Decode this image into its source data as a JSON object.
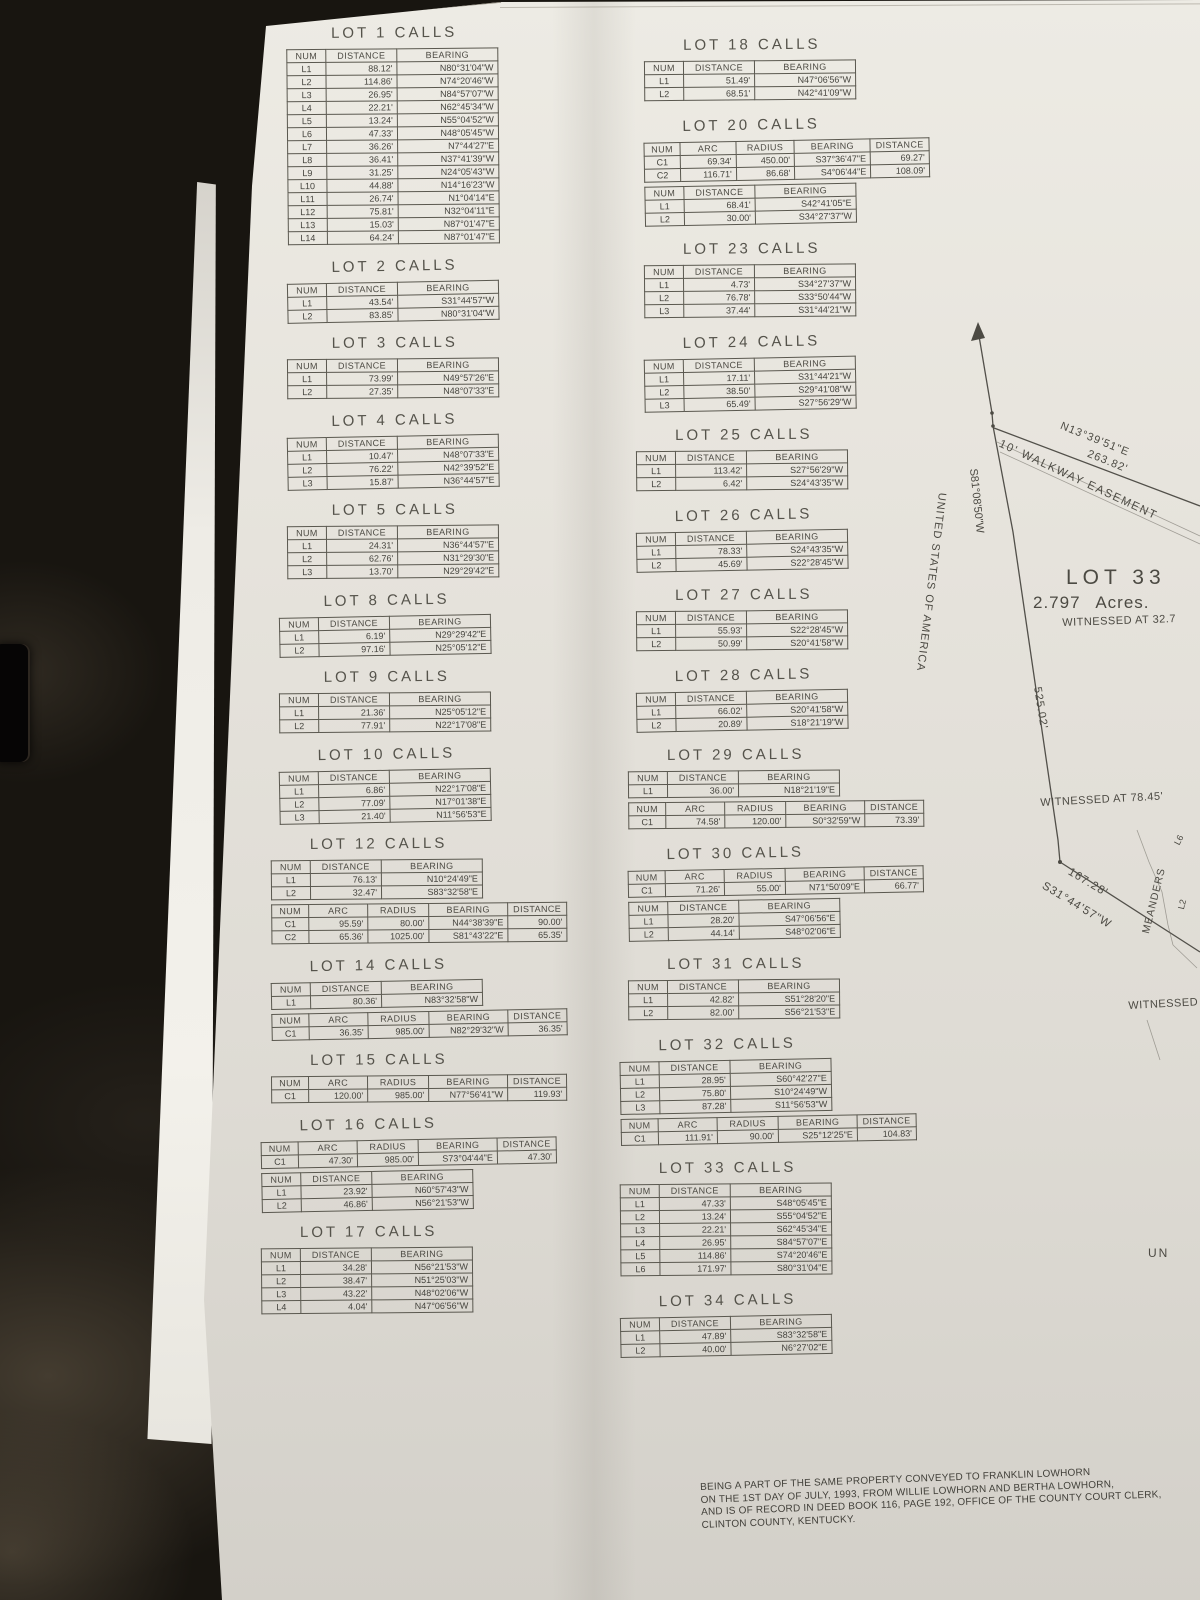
{
  "headers": {
    "line": [
      "NUM",
      "DISTANCE",
      "BEARING"
    ],
    "curve": [
      "NUM",
      "ARC",
      "RADIUS",
      "BEARING",
      "DISTANCE"
    ]
  },
  "columns": [
    {
      "id": "left",
      "lots": [
        {
          "title": "LOT 1 CALLS",
          "tables": [
            {
              "type": "line",
              "rows": [
                [
                  "L1",
                  "88.12'",
                  "N80°31'04\"W"
                ],
                [
                  "L2",
                  "114.86'",
                  "N74°20'46\"W"
                ],
                [
                  "L3",
                  "26.95'",
                  "N84°57'07\"W"
                ],
                [
                  "L4",
                  "22.21'",
                  "N62°45'34\"W"
                ],
                [
                  "L5",
                  "13.24'",
                  "N55°04'52\"W"
                ],
                [
                  "L6",
                  "47.33'",
                  "N48°05'45\"W"
                ],
                [
                  "L7",
                  "36.26'",
                  "N7°44'27\"E"
                ],
                [
                  "L8",
                  "36.41'",
                  "N37°41'39\"W"
                ],
                [
                  "L9",
                  "31.25'",
                  "N24°05'43\"W"
                ],
                [
                  "L10",
                  "44.88'",
                  "N14°16'23\"W"
                ],
                [
                  "L11",
                  "26.74'",
                  "N1°04'14\"E"
                ],
                [
                  "L12",
                  "75.81'",
                  "N32°04'11\"E"
                ],
                [
                  "L13",
                  "15.03'",
                  "N87°01'47\"E"
                ],
                [
                  "L14",
                  "64.24'",
                  "N87°01'47\"E"
                ]
              ]
            }
          ]
        },
        {
          "title": "LOT 2 CALLS",
          "tables": [
            {
              "type": "line",
              "rows": [
                [
                  "L1",
                  "43.54'",
                  "S31°44'57\"W"
                ],
                [
                  "L2",
                  "83.85'",
                  "N80°31'04\"W"
                ]
              ]
            }
          ]
        },
        {
          "title": "LOT 3 CALLS",
          "tables": [
            {
              "type": "line",
              "rows": [
                [
                  "L1",
                  "73.99'",
                  "N49°57'26\"E"
                ],
                [
                  "L2",
                  "27.35'",
                  "N48°07'33\"E"
                ]
              ]
            }
          ]
        },
        {
          "title": "LOT 4 CALLS",
          "tables": [
            {
              "type": "line",
              "rows": [
                [
                  "L1",
                  "10.47'",
                  "N48°07'33\"E"
                ],
                [
                  "L2",
                  "76.22'",
                  "N42°39'52\"E"
                ],
                [
                  "L3",
                  "15.87'",
                  "N36°44'57\"E"
                ]
              ]
            }
          ]
        },
        {
          "title": "LOT 5 CALLS",
          "tables": [
            {
              "type": "line",
              "rows": [
                [
                  "L1",
                  "24.31'",
                  "N36°44'57\"E"
                ],
                [
                  "L2",
                  "62.76'",
                  "N31°29'30\"E"
                ],
                [
                  "L3",
                  "13.70'",
                  "N29°29'42\"E"
                ]
              ]
            }
          ]
        },
        {
          "title": "LOT 8 CALLS",
          "tables": [
            {
              "type": "line",
              "rows": [
                [
                  "L1",
                  "6.19'",
                  "N29°29'42\"E"
                ],
                [
                  "L2",
                  "97.16'",
                  "N25°05'12\"E"
                ]
              ]
            }
          ]
        },
        {
          "title": "LOT 9 CALLS",
          "tables": [
            {
              "type": "line",
              "rows": [
                [
                  "L1",
                  "21.36'",
                  "N25°05'12\"E"
                ],
                [
                  "L2",
                  "77.91'",
                  "N22°17'08\"E"
                ]
              ]
            }
          ]
        },
        {
          "title": "LOT 10 CALLS",
          "tables": [
            {
              "type": "line",
              "rows": [
                [
                  "L1",
                  "6.86'",
                  "N22°17'08\"E"
                ],
                [
                  "L2",
                  "77.09'",
                  "N17°01'38\"E"
                ],
                [
                  "L3",
                  "21.40'",
                  "N11°56'53\"E"
                ]
              ]
            }
          ]
        },
        {
          "title": "LOT 12 CALLS",
          "tables": [
            {
              "type": "line",
              "rows": [
                [
                  "L1",
                  "76.13'",
                  "N10°24'49\"E"
                ],
                [
                  "L2",
                  "32.47'",
                  "S83°32'58\"E"
                ]
              ]
            },
            {
              "type": "curve",
              "rows": [
                [
                  "C1",
                  "95.59'",
                  "80.00'",
                  "N44°38'39\"E",
                  "90.00'"
                ],
                [
                  "C2",
                  "65.36'",
                  "1025.00'",
                  "S81°43'22\"E",
                  "65.35'"
                ]
              ]
            }
          ]
        },
        {
          "title": "LOT 14 CALLS",
          "tables": [
            {
              "type": "line",
              "rows": [
                [
                  "L1",
                  "80.36'",
                  "N83°32'58\"W"
                ]
              ]
            },
            {
              "type": "curve",
              "rows": [
                [
                  "C1",
                  "36.35'",
                  "985.00'",
                  "N82°29'32\"W",
                  "36.35'"
                ]
              ]
            }
          ]
        },
        {
          "title": "LOT 15 CALLS",
          "tables": [
            {
              "type": "curve",
              "rows": [
                [
                  "C1",
                  "120.00'",
                  "985.00'",
                  "N77°56'41\"W",
                  "119.93'"
                ]
              ]
            }
          ]
        },
        {
          "title": "LOT 16 CALLS",
          "tables": [
            {
              "type": "curve",
              "rows": [
                [
                  "C1",
                  "47.30'",
                  "985.00'",
                  "S73°04'44\"E",
                  "47.30'"
                ]
              ]
            },
            {
              "type": "line",
              "rows": [
                [
                  "L1",
                  "23.92'",
                  "N60°57'43\"W"
                ],
                [
                  "L2",
                  "46.86'",
                  "N56°21'53\"W"
                ]
              ]
            }
          ]
        },
        {
          "title": "LOT 17 CALLS",
          "tables": [
            {
              "type": "line",
              "rows": [
                [
                  "L1",
                  "34.28'",
                  "N56°21'53\"W"
                ],
                [
                  "L2",
                  "38.47'",
                  "N51°25'03\"W"
                ],
                [
                  "L3",
                  "43.22'",
                  "N48°02'06\"W"
                ],
                [
                  "L4",
                  "4.04'",
                  "N47°06'56\"W"
                ]
              ]
            }
          ]
        }
      ]
    },
    {
      "id": "right",
      "lots": [
        {
          "title": "LOT 18 CALLS",
          "tables": [
            {
              "type": "line",
              "rows": [
                [
                  "L1",
                  "51.49'",
                  "N47°06'56\"W"
                ],
                [
                  "L2",
                  "68.51'",
                  "N42°41'09\"W"
                ]
              ]
            }
          ]
        },
        {
          "title": "LOT 20 CALLS",
          "tables": [
            {
              "type": "curve",
              "rows": [
                [
                  "C1",
                  "69.34'",
                  "450.00'",
                  "S37°36'47\"E",
                  "69.27'"
                ],
                [
                  "C2",
                  "116.71'",
                  "86.68'",
                  "S4°06'44\"E",
                  "108.09'"
                ]
              ]
            },
            {
              "type": "line",
              "rows": [
                [
                  "L1",
                  "68.41'",
                  "S42°41'05\"E"
                ],
                [
                  "L2",
                  "30.00'",
                  "S34°27'37\"W"
                ]
              ]
            }
          ]
        },
        {
          "title": "LOT 23 CALLS",
          "tables": [
            {
              "type": "line",
              "rows": [
                [
                  "L1",
                  "4.73'",
                  "S34°27'37\"W"
                ],
                [
                  "L2",
                  "76.78'",
                  "S33°50'44\"W"
                ],
                [
                  "L3",
                  "37.44'",
                  "S31°44'21\"W"
                ]
              ]
            }
          ]
        },
        {
          "title": "LOT 24 CALLS",
          "tables": [
            {
              "type": "line",
              "rows": [
                [
                  "L1",
                  "17.11'",
                  "S31°44'21\"W"
                ],
                [
                  "L2",
                  "38.50'",
                  "S29°41'08\"W"
                ],
                [
                  "L3",
                  "65.49'",
                  "S27°56'29\"W"
                ]
              ]
            }
          ]
        },
        {
          "title": "LOT 25 CALLS",
          "tables": [
            {
              "type": "line",
              "rows": [
                [
                  "L1",
                  "113.42'",
                  "S27°56'29\"W"
                ],
                [
                  "L2",
                  "6.42'",
                  "S24°43'35\"W"
                ]
              ]
            }
          ]
        },
        {
          "title": "LOT 26 CALLS",
          "tables": [
            {
              "type": "line",
              "rows": [
                [
                  "L1",
                  "78.33'",
                  "S24°43'35\"W"
                ],
                [
                  "L2",
                  "45.69'",
                  "S22°28'45\"W"
                ]
              ]
            }
          ]
        },
        {
          "title": "LOT 27 CALLS",
          "tables": [
            {
              "type": "line",
              "rows": [
                [
                  "L1",
                  "55.93'",
                  "S22°28'45\"W"
                ],
                [
                  "L2",
                  "50.99'",
                  "S20°41'58\"W"
                ]
              ]
            }
          ]
        },
        {
          "title": "LOT 28 CALLS",
          "tables": [
            {
              "type": "line",
              "rows": [
                [
                  "L1",
                  "66.02'",
                  "S20°41'58\"W"
                ],
                [
                  "L2",
                  "20.89'",
                  "S18°21'19\"W"
                ]
              ]
            }
          ]
        },
        {
          "title": "LOT 29 CALLS",
          "tables": [
            {
              "type": "line",
              "rows": [
                [
                  "L1",
                  "36.00'",
                  "N18°21'19\"E"
                ]
              ]
            },
            {
              "type": "curve",
              "rows": [
                [
                  "C1",
                  "74.58'",
                  "120.00'",
                  "S0°32'59\"W",
                  "73.39'"
                ]
              ]
            }
          ]
        },
        {
          "title": "LOT 30 CALLS",
          "tables": [
            {
              "type": "curve",
              "rows": [
                [
                  "C1",
                  "71.26'",
                  "55.00'",
                  "N71°50'09\"E",
                  "66.77'"
                ]
              ]
            },
            {
              "type": "line",
              "rows": [
                [
                  "L1",
                  "28.20'",
                  "S47°06'56\"E"
                ],
                [
                  "L2",
                  "44.14'",
                  "S48°02'06\"E"
                ]
              ]
            }
          ]
        },
        {
          "title": "LOT 31 CALLS",
          "tables": [
            {
              "type": "line",
              "rows": [
                [
                  "L1",
                  "42.82'",
                  "S51°28'20\"E"
                ],
                [
                  "L2",
                  "82.00'",
                  "S56°21'53\"E"
                ]
              ]
            }
          ]
        },
        {
          "title": "LOT 32 CALLS",
          "tables": [
            {
              "type": "line",
              "rows": [
                [
                  "L1",
                  "28.95'",
                  "S60°42'27\"E"
                ],
                [
                  "L2",
                  "75.80'",
                  "S10°24'49\"W"
                ],
                [
                  "L3",
                  "87.28'",
                  "S11°56'53\"W"
                ]
              ]
            },
            {
              "type": "curve",
              "rows": [
                [
                  "C1",
                  "111.91'",
                  "90.00'",
                  "S25°12'25\"E",
                  "104.83'"
                ]
              ]
            }
          ]
        },
        {
          "title": "LOT 33 CALLS",
          "tables": [
            {
              "type": "line",
              "rows": [
                [
                  "L1",
                  "47.33'",
                  "S48°05'45\"E"
                ],
                [
                  "L2",
                  "13.24'",
                  "S55°04'52\"E"
                ],
                [
                  "L3",
                  "22.21'",
                  "S62°45'34\"E"
                ],
                [
                  "L4",
                  "26.95'",
                  "S84°57'07\"E"
                ],
                [
                  "L5",
                  "114.86'",
                  "S74°20'46\"E"
                ],
                [
                  "L6",
                  "171.97'",
                  "S80°31'04\"E"
                ]
              ]
            }
          ]
        },
        {
          "title": "LOT 34 CALLS",
          "tables": [
            {
              "type": "line",
              "rows": [
                [
                  "L1",
                  "47.89'",
                  "S83°32'58\"E"
                ],
                [
                  "L2",
                  "40.00'",
                  "N6°27'02\"E"
                ]
              ]
            }
          ]
        }
      ]
    }
  ],
  "map": {
    "usa": "UNITED STATES OF AMERICA",
    "s81": "S81°08'50\"W",
    "n13": "N13°39'51\"E",
    "d263": "263.82'",
    "walkway": "10' WALKWAY EASEMENT",
    "lot33": "LOT 33",
    "acres": "2.797  Acres.",
    "wit327": "WITNESSED AT 32.7",
    "d525": "525.02'",
    "wit7845": "WITNESSED AT 78.45'",
    "d16728": "167.28'",
    "s3144": "S31°44'57\"W",
    "meanders": "MEANDERS",
    "l2": "L2",
    "l6": "L6",
    "witA": "WITNESSED A",
    "un": "UN"
  },
  "note": {
    "lines": [
      "BEING A PART OF THE SAME PROPERTY CONVEYED TO FRANKLIN LOWHORN",
      "ON THE 1ST DAY OF JULY, 1993, FROM WILLIE LOWHORN AND BERTHA LOWHORN,",
      "AND IS OF RECORD IN DEED BOOK 116, PAGE 192, OFFICE OF THE COUNTY COURT CLERK,",
      "CLINTON COUNTY, KENTUCKY."
    ]
  }
}
